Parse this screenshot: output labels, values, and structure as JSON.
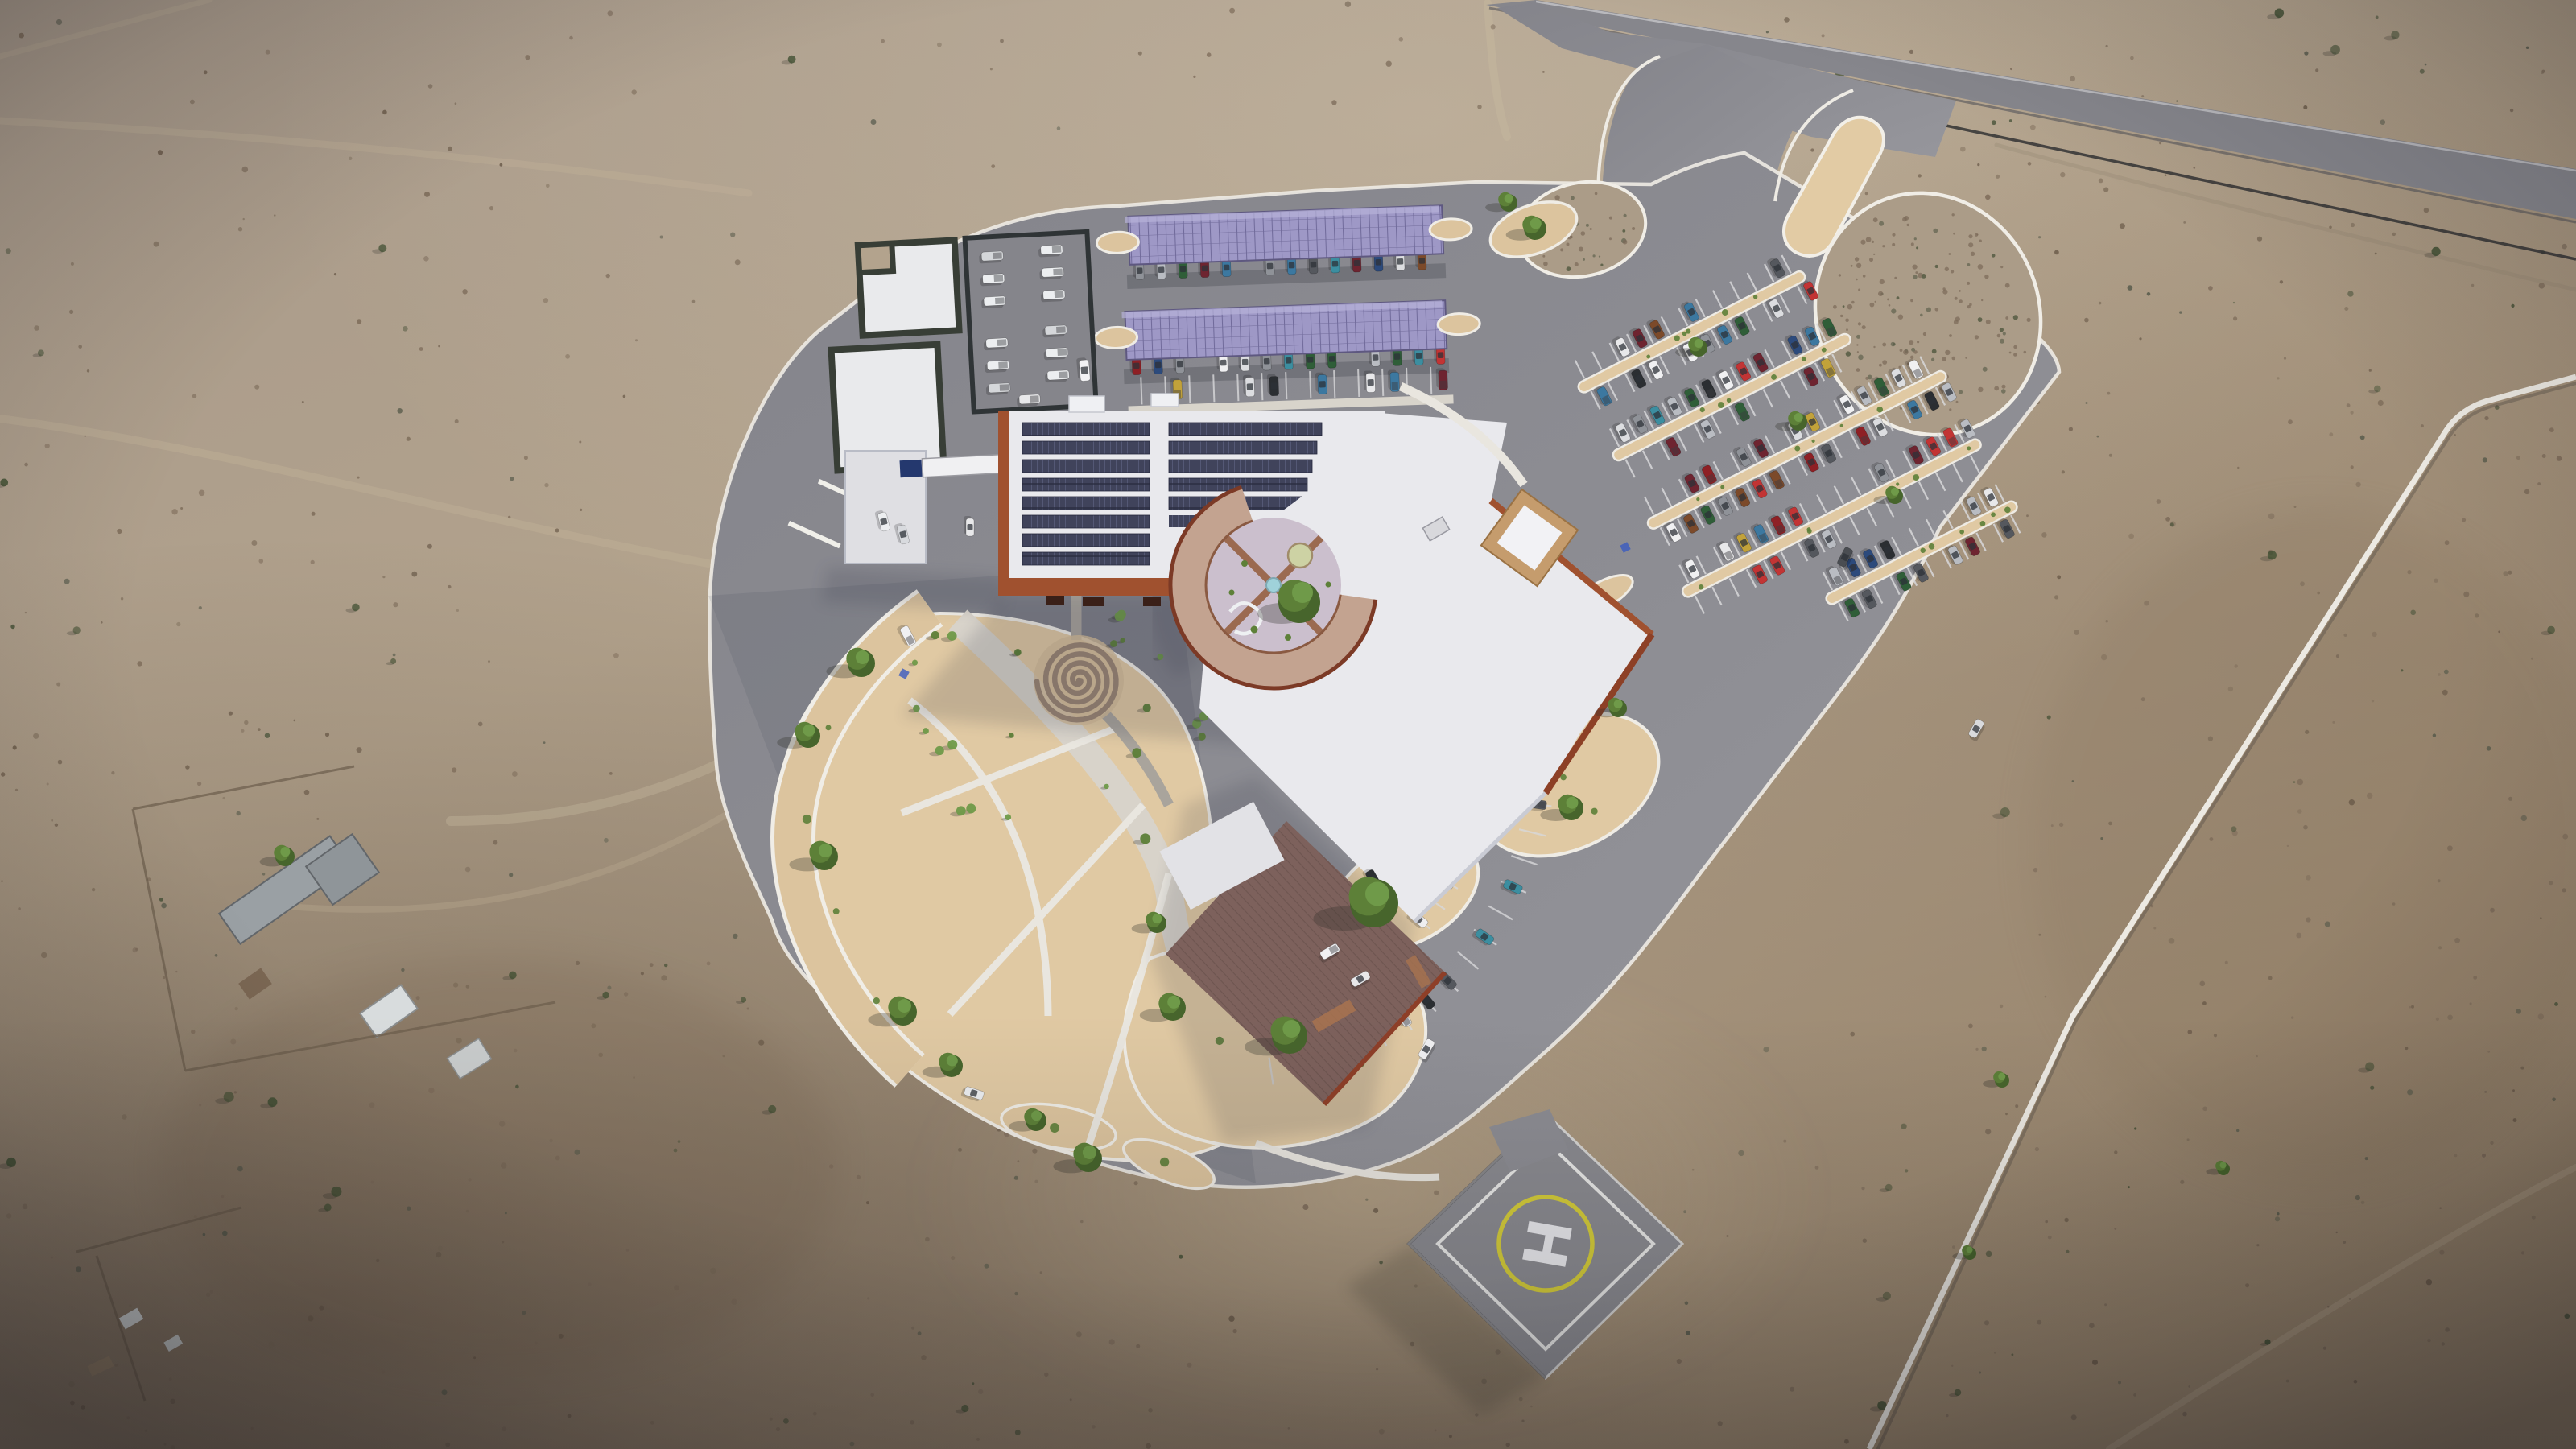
{
  "helipad": {
    "label": "H"
  },
  "palette": {
    "desertA": "#a89a8b",
    "desertB": "#b3a38d",
    "desertC": "#9b8871",
    "sand": "#e0c9a3",
    "sandDeep": "#cdb493",
    "road": "#8d8d93",
    "roadLight": "#97979d",
    "curb": "#eeebe4",
    "roofWhite": "#e9e9ed",
    "roofShade": "#cdced6",
    "terra": "#a0512f",
    "terraDeep": "#7c3220",
    "ringTan": "#c3a390",
    "courtyard": "#cbbfcd",
    "mauve": "#8f7065",
    "pvRoof": "#40435b",
    "pvCarport": "#9e98c6",
    "pvGrid": "#6f6a9b",
    "hedge": "#383e36",
    "helipadPad": "#8b8b90",
    "heliYellow": "#d5cd3a",
    "pathWhite": "#eae7e0",
    "water": "#9fd2da",
    "accessBlue": "#3b5bc0",
    "trackTan": "#c6b79d",
    "fence": "#35353a",
    "treeGreen": "#5d8038",
    "treeDark": "#47652c",
    "treeLight": "#6f9a49",
    "carColors": [
      "#e8e8ea",
      "#dcdde0",
      "#b9bcc2",
      "#8f9298",
      "#55585e",
      "#2b2e32",
      "#8e2025",
      "#c23434",
      "#6e2430",
      "#2c4a7c",
      "#3c78a0",
      "#3c8ea0",
      "#2f5e38",
      "#c2a23a",
      "#7c4a2a",
      "#f0f0f2"
    ]
  }
}
